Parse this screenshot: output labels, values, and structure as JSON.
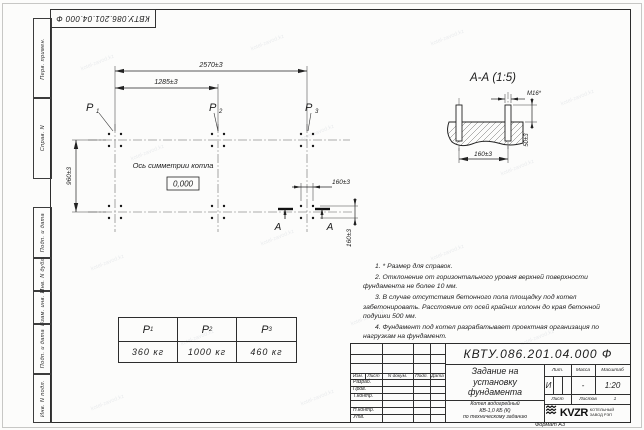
{
  "sheet": {
    "doc_number": "КВТУ.086.201.04.000  Ф",
    "format_label": "Формат А3",
    "watermark": "kotel-zavod.kz"
  },
  "margin": {
    "top_fields": [
      "Перв. примен.",
      "Справ. N"
    ],
    "bottom_fields": [
      "Подп. и дата",
      "Инв. N дубл.",
      "Взам. инв. N",
      "Подп. и дата",
      "Инв. N подл."
    ]
  },
  "plan": {
    "dim_width_total": "2570±3",
    "dim_width_half": "1285±3",
    "dim_depth": "960±3",
    "dim_bolt_x": "160±3",
    "dim_bolt_y": "160±3",
    "axis_label": "Ось симметрии котла",
    "level_mark": "0,000",
    "section_letter": "А",
    "loads": [
      {
        "p": "P",
        "sub": "1"
      },
      {
        "p": "P",
        "sub": "2"
      },
      {
        "p": "P",
        "sub": "3"
      }
    ]
  },
  "section_view": {
    "title": "А-А (1:5)",
    "bolt_callout": "М16*",
    "dim_height": "50±3",
    "dim_spacing": "160±3"
  },
  "notes": [
    "1. * Размер для справок.",
    "2. Отклонение от горизонтального уровня верхней поверхности фундамента не более 10 мм.",
    "3. В случае отсутствия бетонного пола площадку под котел забетонировать. Расстояние от осей крайних колонн до края бетонной подушки 500 мм.",
    "4. Фундамент под котел разрабатывает проектная организация по нагрузкам на фундамент."
  ],
  "load_table": {
    "headers": [
      {
        "p": "P",
        "sub": "1"
      },
      {
        "p": "P",
        "sub": "2"
      },
      {
        "p": "P",
        "sub": "3"
      }
    ],
    "values": [
      "360 кг",
      "1000 кг",
      "460 кг"
    ]
  },
  "title_block": {
    "doc_number": "КВТУ.086.201.04.000  Ф",
    "title_lines": [
      "Задание на",
      "установку",
      "фундамента"
    ],
    "subtitle_lines": [
      "Котел водогрейный",
      "КВ-1,0 КБ (К)",
      "по техническому заданию"
    ],
    "header_cols": {
      "izm": "Изм.",
      "list": "Лист",
      "ndoc": "N докум.",
      "podp": "Подп.",
      "data": "Дата"
    },
    "roles": [
      "Разраб.",
      "Пров.",
      "Т.контр.",
      "Н.контр.",
      "Утв."
    ],
    "lit_label": "Лит.",
    "mass_label": "Масса",
    "scale_label": "Масштаб",
    "lit_value": "И",
    "mass_value": "-",
    "scale_value": "1:20",
    "sheet_label": "Лист",
    "sheets_label": "Листов",
    "sheets_value": "1",
    "logo_text": "KVZR",
    "logo_caption": [
      "КОТЕЛЬНЫЙ",
      "ЗАВОД РЭП"
    ]
  }
}
